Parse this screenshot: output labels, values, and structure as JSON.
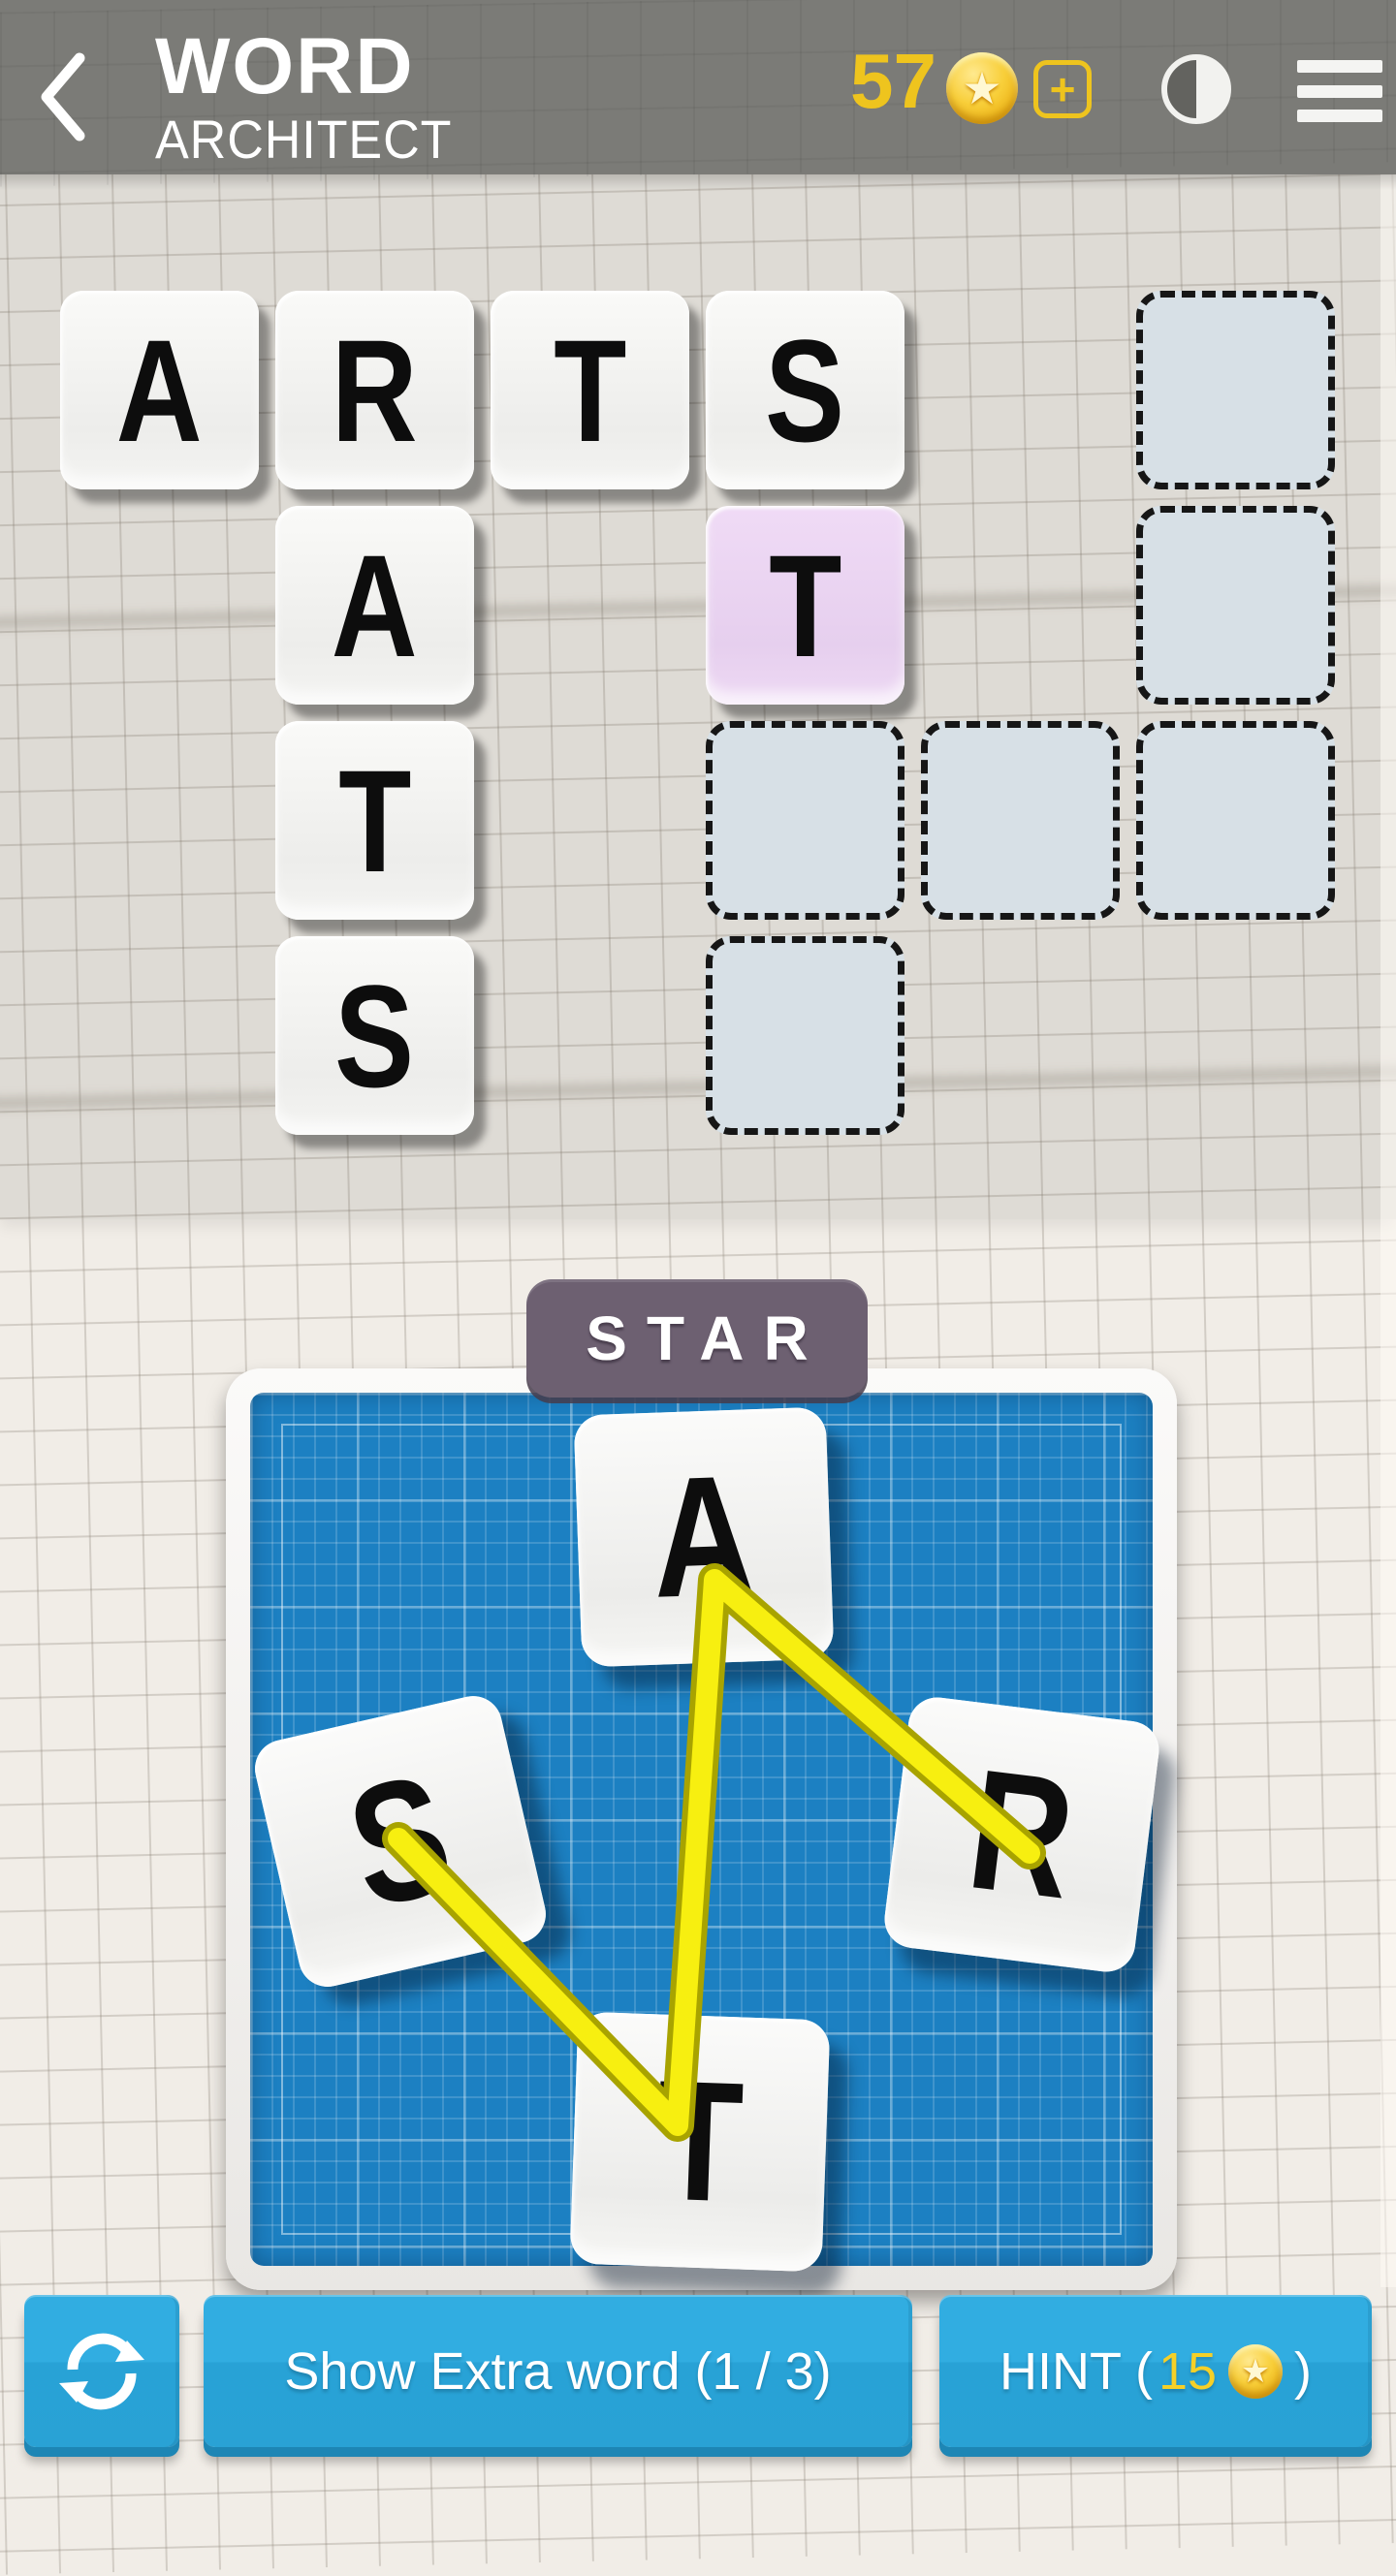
{
  "header": {
    "app_title_line1": "WORD",
    "app_title_line2": "ARCHITECT",
    "coin_count": "57",
    "icons": {
      "back": "chevron-left",
      "coin": "star-coin",
      "add_coins": "plus-square",
      "contrast": "half-filled-circle",
      "menu": "hamburger"
    }
  },
  "colors": {
    "top_bar": "#7b7b77",
    "gold": "#eec41e",
    "button": "#2fa9dd",
    "button_edge": "#1d86b5",
    "wheel_background": "#1c80c2",
    "highlight_tile": "#ead3f1",
    "empty_cell": "#d7e0e6",
    "badge": "#6d6071",
    "trace": "#f7ef10",
    "trace_edge": "#a8a300"
  },
  "puzzle": {
    "solved_words": [
      "ARTS",
      "RATS"
    ],
    "current_word": "STAR",
    "grid": {
      "rows": 4,
      "cols": 6,
      "cells": [
        {
          "row": 0,
          "col": 0,
          "letter": "A",
          "state": "filled"
        },
        {
          "row": 0,
          "col": 1,
          "letter": "R",
          "state": "filled"
        },
        {
          "row": 0,
          "col": 2,
          "letter": "T",
          "state": "filled"
        },
        {
          "row": 0,
          "col": 3,
          "letter": "S",
          "state": "filled"
        },
        {
          "row": 0,
          "col": 5,
          "letter": "",
          "state": "empty"
        },
        {
          "row": 1,
          "col": 1,
          "letter": "A",
          "state": "filled"
        },
        {
          "row": 1,
          "col": 3,
          "letter": "T",
          "state": "highlight"
        },
        {
          "row": 1,
          "col": 5,
          "letter": "",
          "state": "empty"
        },
        {
          "row": 2,
          "col": 1,
          "letter": "T",
          "state": "filled"
        },
        {
          "row": 2,
          "col": 3,
          "letter": "",
          "state": "empty"
        },
        {
          "row": 2,
          "col": 4,
          "letter": "",
          "state": "empty"
        },
        {
          "row": 2,
          "col": 5,
          "letter": "",
          "state": "empty"
        },
        {
          "row": 3,
          "col": 1,
          "letter": "S",
          "state": "filled"
        },
        {
          "row": 3,
          "col": 3,
          "letter": "",
          "state": "empty"
        }
      ]
    }
  },
  "word_preview": {
    "text": "STAR"
  },
  "wheel": {
    "letters": [
      {
        "letter": "A",
        "position": "top",
        "rotation": -2
      },
      {
        "letter": "S",
        "position": "left",
        "rotation": -13
      },
      {
        "letter": "R",
        "position": "right",
        "rotation": 7
      },
      {
        "letter": "T",
        "position": "bottom",
        "rotation": 2
      }
    ],
    "trace_order": "S-T-A-R",
    "trace_points": [
      [
        411,
        1897
      ],
      [
        699,
        2193
      ],
      [
        737,
        1630
      ],
      [
        1062,
        1912
      ]
    ]
  },
  "footer": {
    "shuffle_icon": "sync-arrows",
    "extra_word_label": "Show Extra word (1 / 3)",
    "hint_prefix": "HINT (",
    "hint_cost": "15",
    "hint_suffix": ")"
  }
}
